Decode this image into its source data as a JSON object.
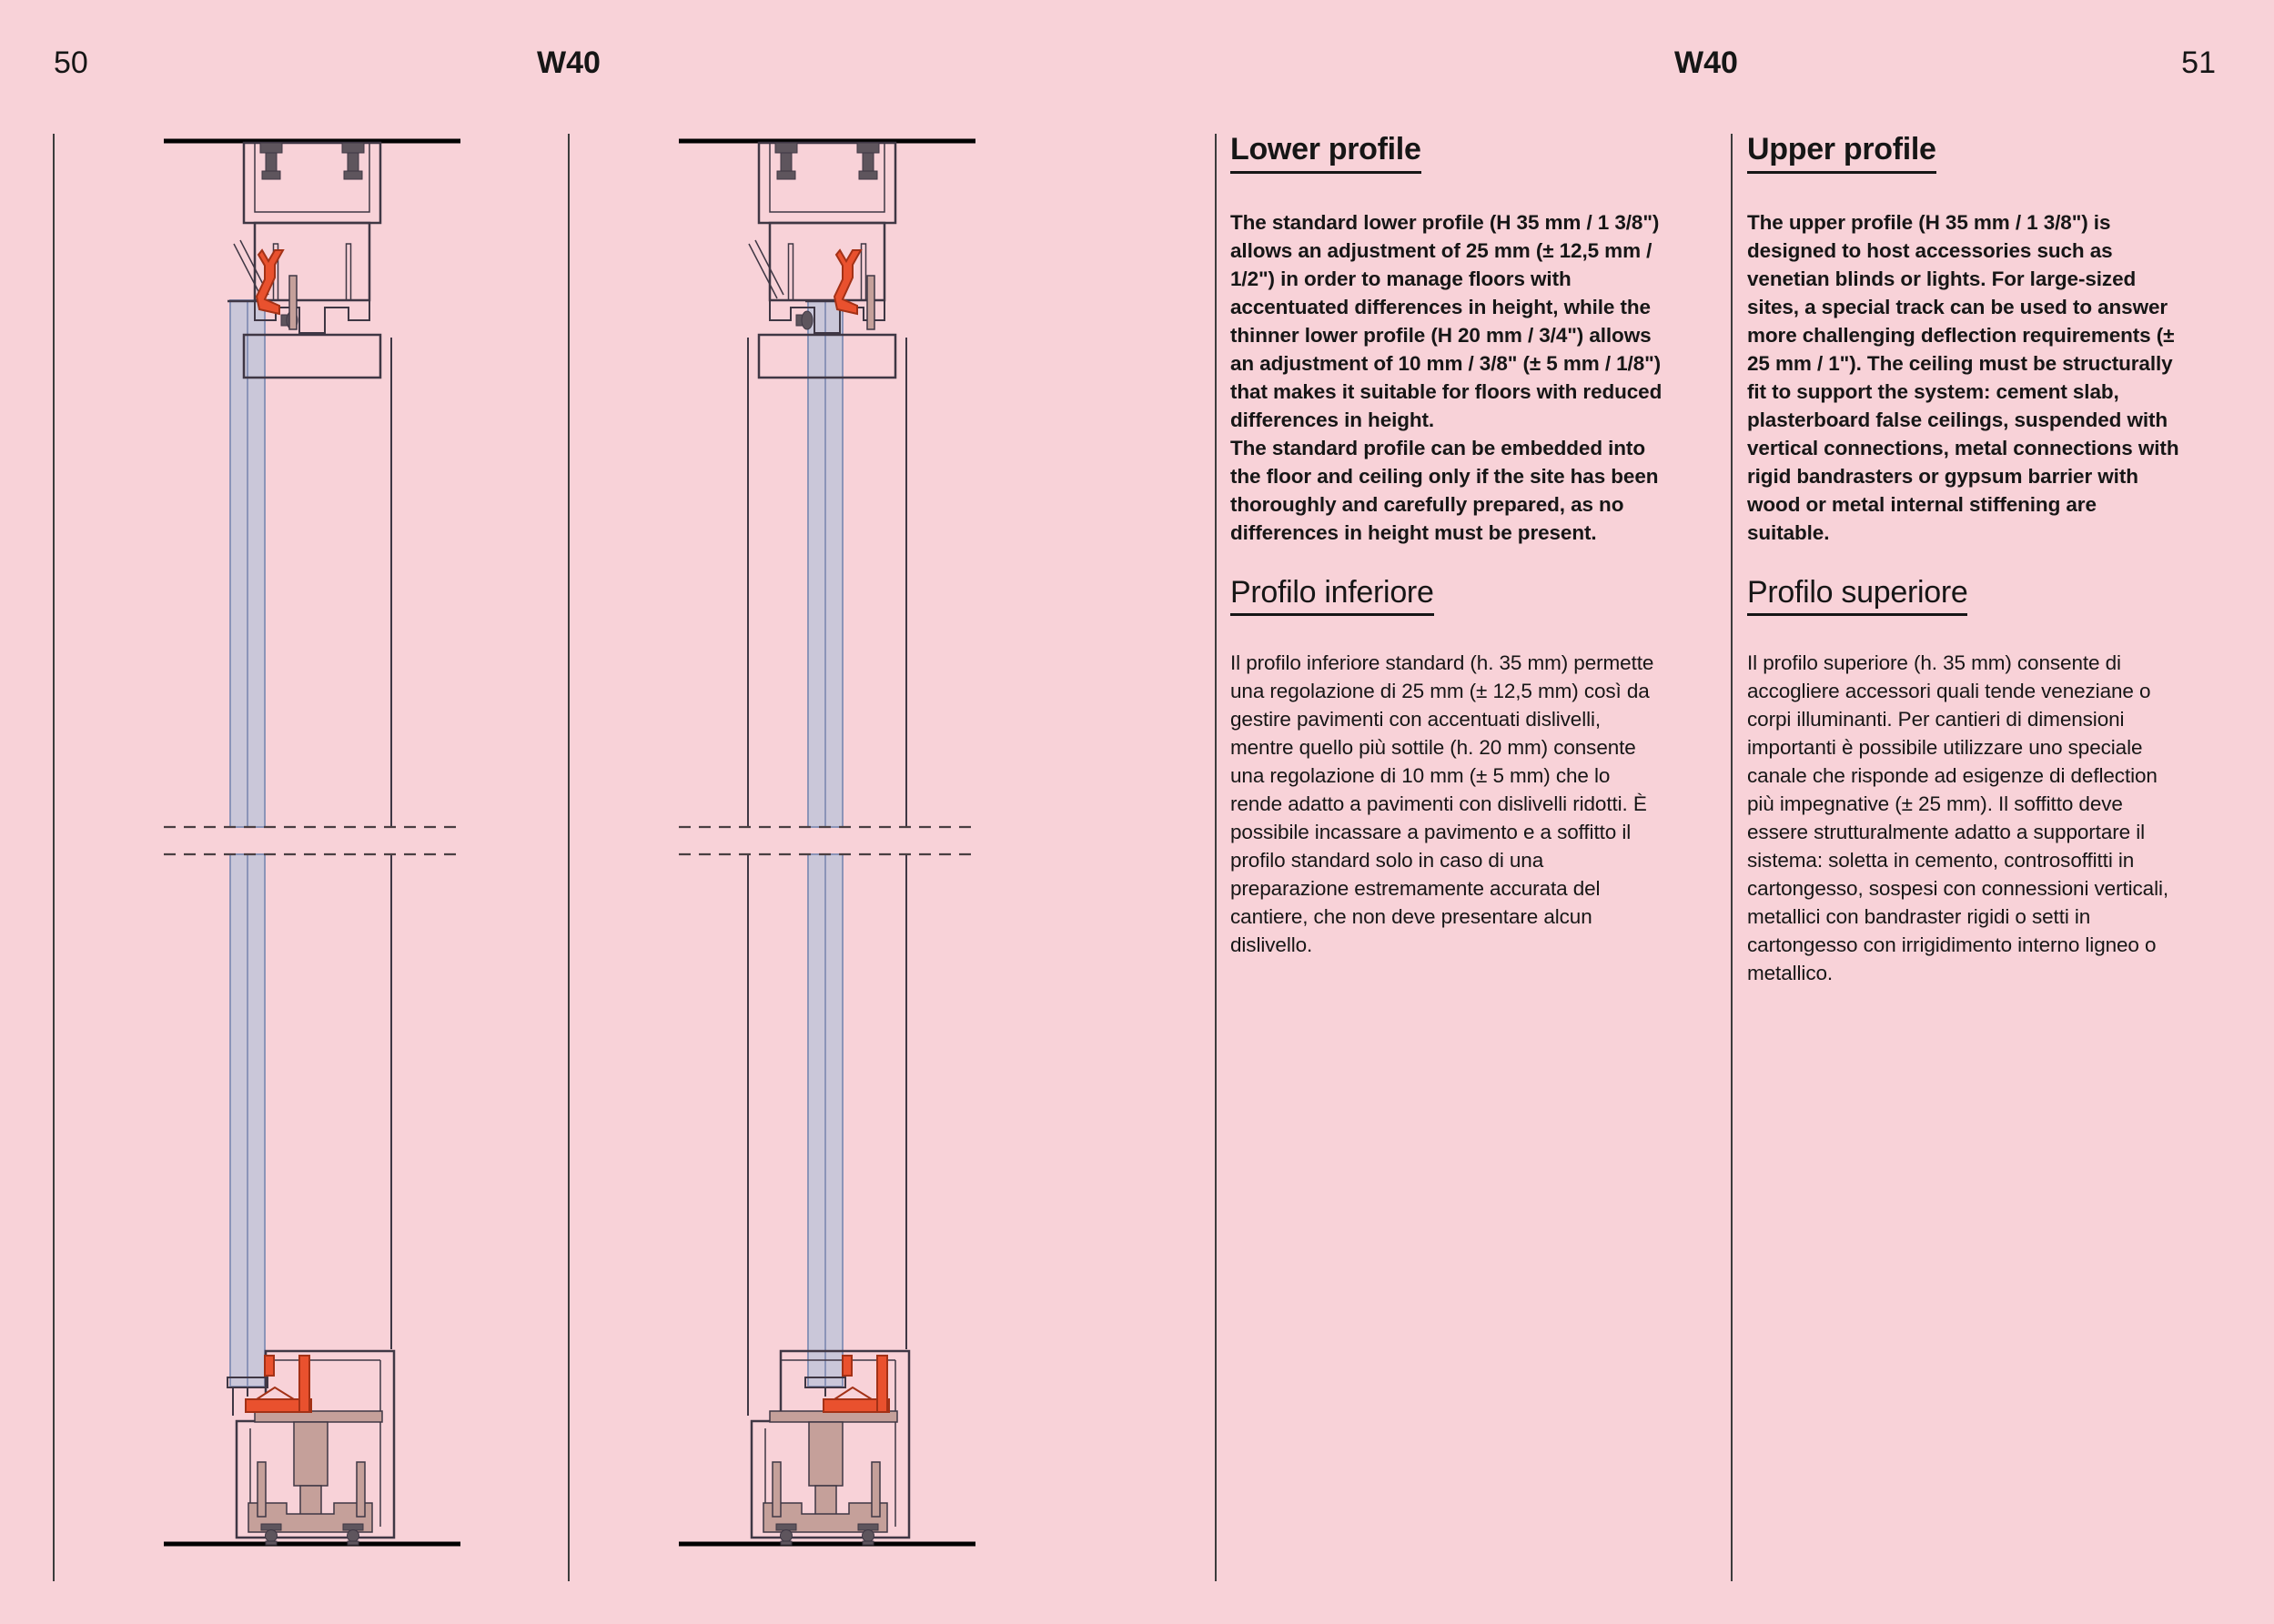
{
  "left_page": {
    "page_number": "50",
    "title": "W40"
  },
  "right_page": {
    "title": "W40",
    "page_number": "51",
    "columns": [
      {
        "heading_en": "Lower profile",
        "body_en": "The standard lower profile (H 35 mm / 1 3/8\") allows an adjustment of 25 mm (± 12,5 mm / 1/2\") in order to manage floors with accentuated differences in height, while the thinner lower profile (H 20 mm / 3/4\") allows an adjustment of 10 mm / 3/8\" (± 5 mm / 1/8\") that makes it suitable for floors with reduced differences in height.\nThe standard profile can be embedded into the floor and ceiling only if the site has been thoroughly and carefully prepared, as no differences in height must be present.",
        "heading_it": "Profilo inferiore",
        "body_it": "Il profilo inferiore standard (h. 35 mm) permette una regolazione di 25 mm (± 12,5 mm) così da gestire pavimenti con accentuati dislivelli, mentre quello più sottile (h. 20 mm) consente una regolazione di 10 mm (± 5 mm) che lo rende adatto a pavimenti con dislivelli ridotti. È possibile incassare a pavimento e a soffitto il profilo standard solo in caso di una preparazione estremamente accurata del cantiere, che non deve presentare alcun dislivello."
      },
      {
        "heading_en": "Upper profile",
        "body_en": "The upper profile (H 35 mm / 1 3/8\") is designed to host accessories such as venetian blinds or lights. For large-sized sites, a special track can be used to answer more challenging deflection requirements (± 25 mm / 1\"). The ceiling must be structurally fit to support the system: cement slab, plasterboard false ceilings, suspended with vertical connections, metal connections with rigid bandrasters or gypsum barrier with wood or metal internal stiffening are suitable.",
        "heading_it": "Profilo superiore",
        "body_it": "Il profilo superiore (h. 35 mm) consente di accogliere accessori quali tende veneziane o corpi illuminanti. Per cantieri di dimensioni importanti è possibile utilizzare uno speciale canale che risponde ad esigenze di deflection più impegnative (± 25 mm). Il soffitto deve essere strutturalmente adatto a supportare il sistema: soletta in cemento, controsoffitti in cartongesso, sospesi con connessioni verticali, metallici con bandraster rigidi o setti in cartongesso con irrigidimento interno ligneo o metallico."
      }
    ]
  },
  "drawings": {
    "description_1": "vertical-section-sliding-panel-left-track",
    "description_2": "vertical-section-sliding-panel-right-track",
    "colors": {
      "background": "#f8d2d8",
      "outline": "#3f3744",
      "line_black": "#000000",
      "dashed_line": "#4a3f42",
      "glass_fill": "#cac7d9",
      "glass_edge": "#8b94b8",
      "red_fill": "#e9512e",
      "red_dark": "#a33116",
      "taupe_fill": "#c5a09a",
      "dark_metal": "#5e555d",
      "rule_gray": "#3c3c3c"
    }
  }
}
